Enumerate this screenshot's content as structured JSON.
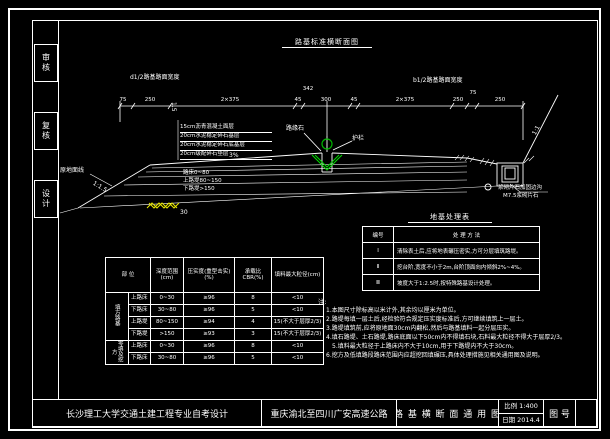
{
  "frame": {
    "sidebar": [
      "审核",
      "复核",
      "设计"
    ],
    "title_block": {
      "school": "长沙理工大学交通土建工程专业自考设计",
      "project": "重庆渝北至四川广安高速公路",
      "sheet_title": "路 基 横 断 面 通 用 图",
      "scale_label": "比例",
      "scale_value": "1:400",
      "date_label": "日期",
      "date_value": "2014.4",
      "figure_no_label": "图 号"
    }
  },
  "drawing": {
    "title": "路基标准横断面图",
    "half_width_left": "d1/2路基路面宽度",
    "half_width_right": "b1/2路基路面宽度",
    "dims": [
      "75",
      "250",
      "2×375",
      "45",
      "300",
      "45",
      "2×375",
      "250",
      "75",
      "250"
    ],
    "dim_center_top": "342",
    "slope_left": "1:1.5",
    "slope_right": "1:1",
    "cross_slope": "3%",
    "median_cross": "1.5",
    "ground_label": "原地面线",
    "layers": [
      "15cm沥青混凝土面层",
      "20cm水泥稳定碎石基层",
      "20cm水泥稳定碎石底基层",
      "20cm级配碎石垫层"
    ],
    "zones": [
      "路床0~80",
      "上路堤80~150",
      "下路堤>150"
    ],
    "topsoil_dim": "30",
    "median_left_label": "路缘石",
    "median_right_label": "护栏",
    "ditch_line1": "浆砌片石加固边沟",
    "ditch_line2": "M7.5浆砌片石"
  },
  "treatment_table": {
    "title": "地基处理表",
    "col1": "编号",
    "col2": "处 理 方 法",
    "rows": [
      {
        "no": "Ⅰ",
        "text": "清除表土后,应将地表碾压密实,方可分层填筑路堤。"
      },
      {
        "no": "Ⅱ",
        "text": "挖台阶,宽度不小于2m,台阶顶面向内倾斜2%~4%。"
      },
      {
        "no": "Ⅲ",
        "text": "坡度大于1:2.5时,按特殊路基设计处理。"
      }
    ]
  },
  "notes": {
    "label": "注:",
    "lines": [
      "1.本图尺寸除标高以米计外,其余均以厘米为单位。",
      "2.路堤每填一层土后,经检验符合规定压实度标准后,方可继续填筑上一层土。",
      "3.路堤填筑前,应将原地面30cm内翻松,然后与路基填料一起分层压实。",
      "4.填石路堤、土石路堤,路床底面以下50cm内不得填石块,石料最大粒径不得大于层厚2/3。",
      "5.填料最大粒径于上路床内不大于10cm,用于下路堤内不大于30cm。",
      "6.挖方及低填路段路床范围内应超挖回填碾压,具体处理措施见相关通用图及说明。"
    ]
  },
  "ctable": {
    "header_part": "部 位",
    "header_depth": "深度范围(cm)",
    "header_compact": "压实度(重型击实)(%)",
    "header_cbr": "承载比CBR(%)",
    "header_grain": "填料最大粒径(cm)",
    "group1": "填方路基",
    "group2": "零填及挖方",
    "rows": [
      [
        "上路床",
        "0~30",
        "≥96",
        "8",
        "<10"
      ],
      [
        "下路床",
        "30~80",
        "≥96",
        "5",
        "<10"
      ],
      [
        "上路堤",
        "80~150",
        "≥94",
        "4",
        "15(不大于层厚2/3)"
      ],
      [
        "下路堤",
        ">150",
        "≥93",
        "3",
        "15(不大于层厚2/3)"
      ],
      [
        "上路床",
        "0~30",
        "≥96",
        "8",
        "<10"
      ],
      [
        "下路床",
        "30~80",
        "≥96",
        "5",
        "<10"
      ]
    ]
  }
}
